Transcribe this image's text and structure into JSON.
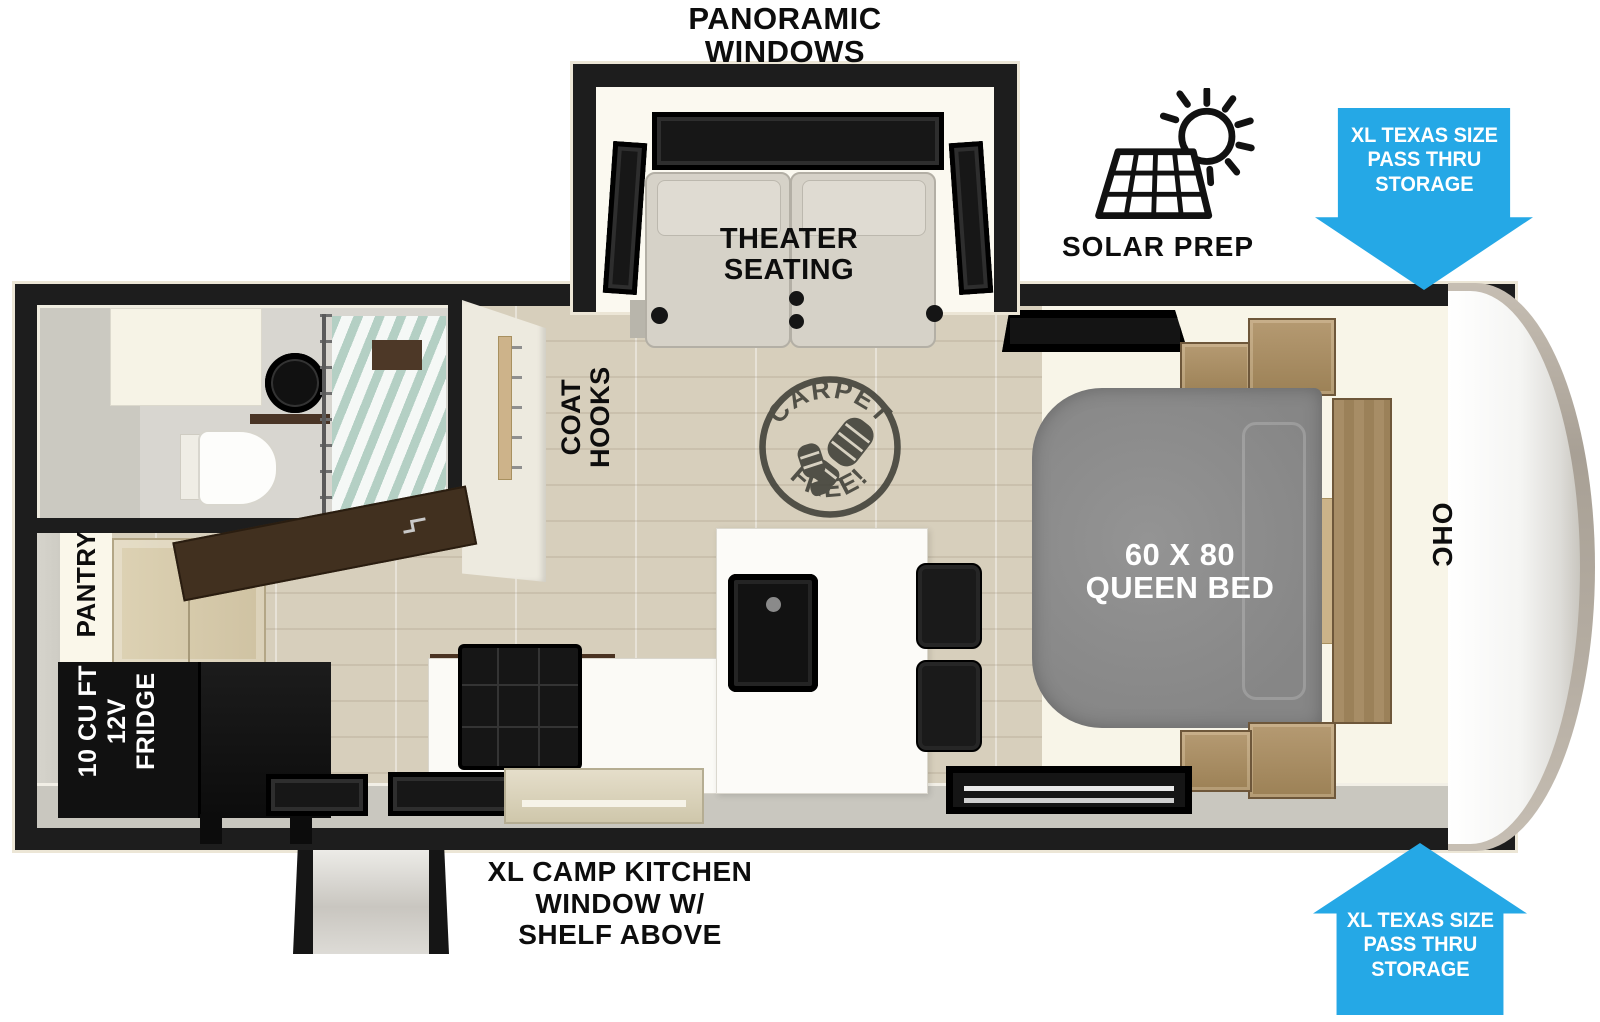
{
  "labels": {
    "title": {
      "line1": "PANORAMIC",
      "line2": "WINDOWS"
    },
    "theater": {
      "line1": "THEATER",
      "line2": "SEATING"
    },
    "solar": "SOLAR PREP",
    "arrow_top": {
      "line1": "XL TEXAS SIZE",
      "line2": "PASS THRU",
      "line3": "STORAGE"
    },
    "arrow_bottom": {
      "line1": "XL TEXAS SIZE",
      "line2": "PASS THRU",
      "line3": "STORAGE"
    },
    "coat_hooks": {
      "line1": "COAT",
      "line2": "HOOKS"
    },
    "carpet_free": {
      "arc_top": "CARPET",
      "arc_bottom": "FREE!"
    },
    "bed": {
      "line1": "60 X 80",
      "line2": "QUEEN BED"
    },
    "ohc": "OHC",
    "pantry": "PANTRY",
    "fridge": {
      "line1": "10 CU FT",
      "line2": "12V",
      "line3": "FRIDGE"
    },
    "camp_kitchen": {
      "line1": "XL CAMP KITCHEN",
      "line2": "WINDOW W/",
      "line3": "SHELF ABOVE"
    }
  },
  "colors": {
    "arrow_blue": "#25A8E6",
    "wall_black": "#1D1D1D",
    "bed_gray": "#8C8C8C",
    "floor_wood": "#D7CFBC",
    "cabinet_wood": "#A98E66",
    "interior_cream": "#F8F5E8",
    "shower_glass": "#ACCEC2"
  }
}
